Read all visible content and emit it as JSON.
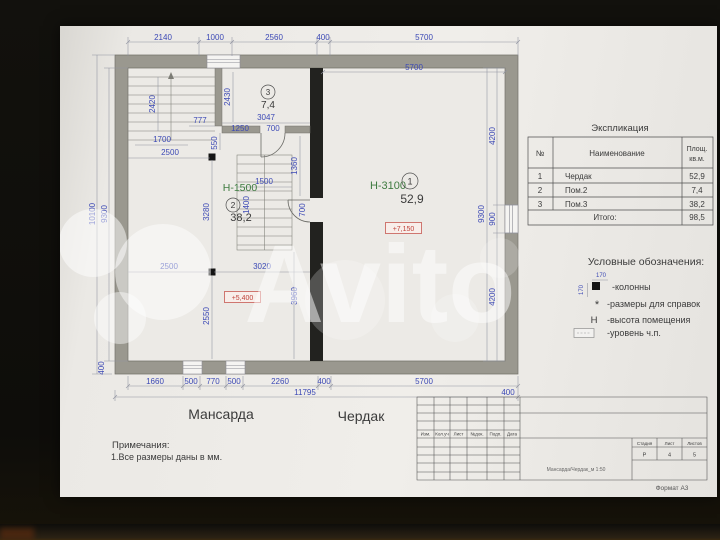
{
  "watermark": {
    "text": "Avito"
  },
  "plan": {
    "rooms": [
      {
        "num": "1",
        "height": "Н-3100",
        "area": "52,9"
      },
      {
        "num": "2",
        "height": "Н-1500",
        "area": "38,2"
      },
      {
        "num": "3",
        "area": "7,4"
      }
    ],
    "levels": {
      "upper": "+7,150",
      "lower": "+5,400"
    },
    "floor_labels": {
      "mansarda": "Мансарда",
      "cherdak": "Чердак"
    },
    "dims": {
      "t2140": "2140",
      "t1000": "1000",
      "t2560": "2560",
      "t400": "400",
      "t5700": "5700",
      "inner5700": "5700",
      "l10100": "10100",
      "l9300": "9300",
      "r9300": "9300",
      "r4200a": "4200",
      "r900": "900",
      "r4200b": "4200",
      "b1660": "1660",
      "b500a": "500",
      "b770": "770",
      "b500b": "500",
      "b2260": "2260",
      "b400": "400",
      "b5700": "5700",
      "b11795": "11795",
      "b400r": "400",
      "b400l": "400",
      "s2420": "2420",
      "s777": "777",
      "s1700": "1700",
      "s2500a": "2500",
      "r3_2430": "2430",
      "r3_3047": "3047",
      "r3_1250": "1250",
      "r3_700": "700",
      "r3_550": "550",
      "r3_1360": "1360",
      "m1500": "1500",
      "m1400": "1400",
      "m700": "700",
      "m3280": "3280",
      "m2500": "2500",
      "m3020": "3020",
      "m2550": "2550",
      "m3960": "3960"
    }
  },
  "table": {
    "title": "Экспликация",
    "col_num": "№",
    "col_name": "Наименование",
    "col_area1": "Площ.",
    "col_area2": "кв.м.",
    "rows": [
      {
        "num": "1",
        "name": "Чердак",
        "area": "52,9"
      },
      {
        "num": "2",
        "name": "Пом.2",
        "area": "7,4"
      },
      {
        "num": "3",
        "name": "Пом.3",
        "area": "38,2"
      }
    ],
    "total_label": "Итого:",
    "total": "98,5"
  },
  "legend": {
    "title": "Условные обозначения:",
    "dim_top": "170",
    "dim_left": "170",
    "items": [
      {
        "label": "-колонны"
      },
      {
        "sym": "*",
        "label": "-размеры для справок"
      },
      {
        "sym": "Н",
        "label": "-высота помещения"
      },
      {
        "label": "-уровень ч.п."
      }
    ]
  },
  "notes": {
    "title": "Примечания:",
    "line1": "1.Все размеры даны в мм."
  },
  "stamp": {
    "headers": [
      "Изм.",
      "Кол.уч",
      "Лист",
      "№док.",
      "Подп.",
      "Дата"
    ],
    "stage_label": "Стадия",
    "sheet_label": "Лист",
    "sheets_label": "Листов",
    "stage": "Р",
    "sheet": "4",
    "sheets": "5",
    "doc_title": "Мансарда/Чердак_м 1:50",
    "format": "Формат А3"
  }
}
